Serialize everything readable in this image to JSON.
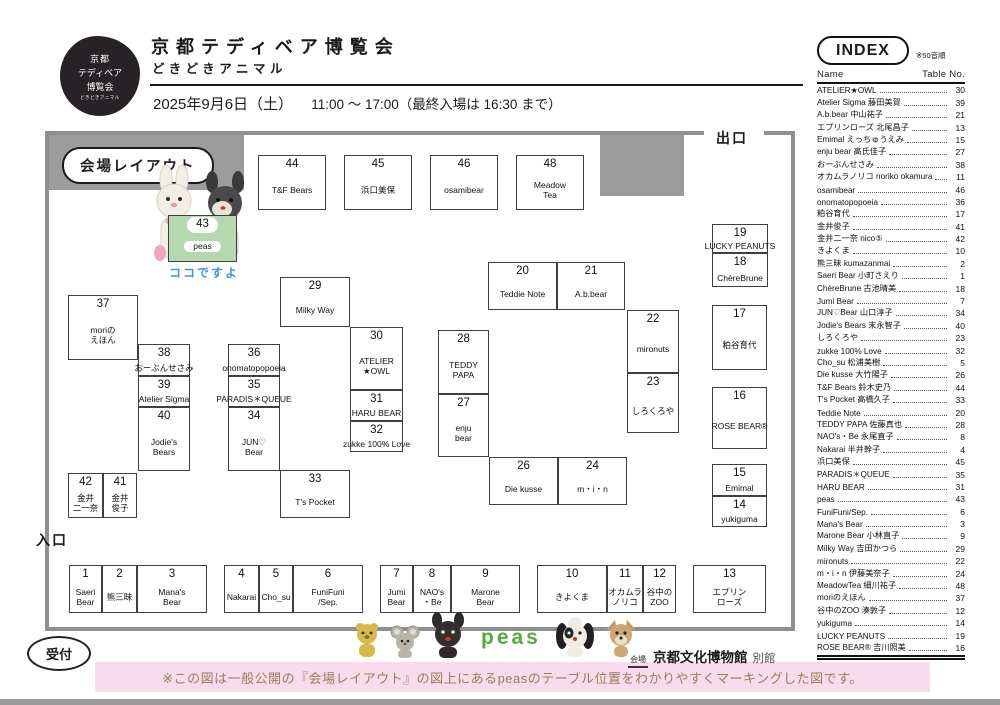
{
  "header": {
    "logo_lines": [
      "京都",
      "テディベア",
      "博覧会",
      "どきどきアニマル"
    ],
    "title": "京都テディベア博覧会",
    "subtitle": "どきどきアニマル",
    "date_main": "2025年9月6日（土）",
    "date_time": "11:00 ～ 17:00（最終入場は 16:30 まで）"
  },
  "index": {
    "title": "INDEX",
    "note": "※50音順",
    "col_name": "Name",
    "col_table": "Table No.",
    "entries": [
      {
        "name": "ATELIER★OWL",
        "no": 30
      },
      {
        "name": "Atelier Sigma 藤田美賀",
        "no": 39
      },
      {
        "name": "A.b.bear 中山祐子",
        "no": 21
      },
      {
        "name": "エプリンローズ 北尾昌子",
        "no": 13
      },
      {
        "name": "Emimal えっちゅうえみ",
        "no": 15
      },
      {
        "name": "enju bear 高氏佳子",
        "no": 27
      },
      {
        "name": "おーぶんせさみ",
        "no": 38
      },
      {
        "name": "オカムラノリコ noriko okamura",
        "no": 11
      },
      {
        "name": "osamibear",
        "no": 46
      },
      {
        "name": "onomatopopoeia",
        "no": 36
      },
      {
        "name": "粕谷育代",
        "no": 17
      },
      {
        "name": "金井俊子",
        "no": 41
      },
      {
        "name": "金井二一奈 nico⑤",
        "no": 42
      },
      {
        "name": "きよくま",
        "no": 10
      },
      {
        "name": "熊三昧 kumazanmai",
        "no": 2
      },
      {
        "name": "Saeri Bear 小町さえり",
        "no": 1
      },
      {
        "name": "ChèreBrune 古池晴美",
        "no": 18
      },
      {
        "name": "Jumi Bear",
        "no": 7
      },
      {
        "name": "JUN♡Bear 山口淳子",
        "no": 34
      },
      {
        "name": "Jodie's Bears 末永智子",
        "no": 40
      },
      {
        "name": "しろくろや",
        "no": 23
      },
      {
        "name": "zukke 100% Love",
        "no": 32
      },
      {
        "name": "Cho_su 松浦美樹",
        "no": 5
      },
      {
        "name": "Die kusse 大竹陽子",
        "no": 26
      },
      {
        "name": "T&F Bears 鈴木史乃",
        "no": 44
      },
      {
        "name": "T's Pocket 高橋久子",
        "no": 33
      },
      {
        "name": "Teddie Note",
        "no": 20
      },
      {
        "name": "TEDDY PAPA 佐藤真也",
        "no": 28
      },
      {
        "name": "NAO's・Be 永尾直子",
        "no": 8
      },
      {
        "name": "Nakarai 半井幹子",
        "no": 4
      },
      {
        "name": "浜口美保",
        "no": 45
      },
      {
        "name": "PARADIS＊QUEUE",
        "no": 35
      },
      {
        "name": "HARU BEAR",
        "no": 31
      },
      {
        "name": "peas",
        "no": 43
      },
      {
        "name": "FuniFuni/Sep.",
        "no": 6
      },
      {
        "name": "Mana's Bear",
        "no": 3
      },
      {
        "name": "Marone Bear 小林直子",
        "no": 9
      },
      {
        "name": "Milky Way 吉田かつら",
        "no": 29
      },
      {
        "name": "mironuts",
        "no": 22
      },
      {
        "name": "m・i・n 伊藤美奈子",
        "no": 24
      },
      {
        "name": "MeadowTea 細川祐子",
        "no": 48
      },
      {
        "name": "moriのえほん",
        "no": 37
      },
      {
        "name": "谷中のZOO 湊敦子",
        "no": 12
      },
      {
        "name": "yukiguma",
        "no": 14
      },
      {
        "name": "LUCKY PEANUTS",
        "no": 19
      },
      {
        "name": "ROSE BEAR® 吉川照美",
        "no": 16
      }
    ]
  },
  "map": {
    "legend_label": "会場レイアウト",
    "exit_label": "出口",
    "entrance_label": "入口",
    "reception_label": "受付",
    "here_label": "ココですよ",
    "highlight_table": "43",
    "highlight_name": "peas",
    "tables": [
      {
        "no": "44",
        "label": "T&F Bears",
        "x": 258,
        "y": 155,
        "w": 68,
        "h": 55
      },
      {
        "no": "45",
        "label": "浜口美保",
        "x": 344,
        "y": 155,
        "w": 68,
        "h": 55
      },
      {
        "no": "46",
        "label": "osamibear",
        "x": 430,
        "y": 155,
        "w": 68,
        "h": 55
      },
      {
        "no": "48",
        "label": "Meadow\nTea",
        "x": 516,
        "y": 155,
        "w": 68,
        "h": 55
      },
      {
        "no": "43",
        "label": "peas",
        "x": 168,
        "y": 215,
        "w": 69,
        "h": 47,
        "hl": true
      },
      {
        "no": "37",
        "label": "moriの\nえほん",
        "x": 68,
        "y": 295,
        "w": 70,
        "h": 65
      },
      {
        "no": "38",
        "label": "おーぶんせさみ",
        "x": 138,
        "y": 344,
        "w": 52,
        "h": 32
      },
      {
        "no": "39",
        "label": "Atelier Sigma",
        "x": 138,
        "y": 376,
        "w": 52,
        "h": 31
      },
      {
        "no": "40",
        "label": "Jodie's\nBears",
        "x": 138,
        "y": 407,
        "w": 52,
        "h": 64
      },
      {
        "no": "42",
        "label": "金井\n二一奈",
        "x": 68,
        "y": 473,
        "w": 35,
        "h": 45
      },
      {
        "no": "41",
        "label": "金井\n俊子",
        "x": 103,
        "y": 473,
        "w": 34,
        "h": 45
      },
      {
        "no": "36",
        "label": "onomatopopoeia",
        "x": 228,
        "y": 344,
        "w": 52,
        "h": 32
      },
      {
        "no": "35",
        "label": "PARADIS＊QUEUE",
        "x": 228,
        "y": 376,
        "w": 52,
        "h": 31
      },
      {
        "no": "34",
        "label": "JUN♡\nBear",
        "x": 228,
        "y": 407,
        "w": 52,
        "h": 64
      },
      {
        "no": "33",
        "label": "T's Pocket",
        "x": 280,
        "y": 470,
        "w": 70,
        "h": 48
      },
      {
        "no": "29",
        "label": "Milky Way",
        "x": 280,
        "y": 277,
        "w": 70,
        "h": 50
      },
      {
        "no": "30",
        "label": "ATELIER\n★OWL",
        "x": 350,
        "y": 327,
        "w": 53,
        "h": 63
      },
      {
        "no": "31",
        "label": "HARU BEAR",
        "x": 350,
        "y": 390,
        "w": 53,
        "h": 31
      },
      {
        "no": "32",
        "label": "zukke 100% Love",
        "x": 350,
        "y": 421,
        "w": 53,
        "h": 31
      },
      {
        "no": "20",
        "label": "Teddie Note",
        "x": 488,
        "y": 262,
        "w": 69,
        "h": 48
      },
      {
        "no": "21",
        "label": "A.b.bear",
        "x": 557,
        "y": 262,
        "w": 68,
        "h": 48
      },
      {
        "no": "22",
        "label": "mironuts",
        "x": 627,
        "y": 310,
        "w": 52,
        "h": 63
      },
      {
        "no": "23",
        "label": "しろくろや",
        "x": 627,
        "y": 373,
        "w": 52,
        "h": 60
      },
      {
        "no": "28",
        "label": "TEDDY\nPAPA",
        "x": 438,
        "y": 330,
        "w": 51,
        "h": 64
      },
      {
        "no": "27",
        "label": "enju\nbear",
        "x": 438,
        "y": 394,
        "w": 51,
        "h": 63
      },
      {
        "no": "26",
        "label": "Die kusse",
        "x": 489,
        "y": 457,
        "w": 69,
        "h": 48
      },
      {
        "no": "24",
        "label": "m・i・n",
        "x": 558,
        "y": 457,
        "w": 69,
        "h": 48
      },
      {
        "no": "19",
        "label": "LUCKY PEANUTS",
        "x": 712,
        "y": 224,
        "w": 56,
        "h": 29
      },
      {
        "no": "18",
        "label": "ChèreBrune",
        "x": 712,
        "y": 253,
        "w": 56,
        "h": 34
      },
      {
        "no": "17",
        "label": "粕谷育代",
        "x": 712,
        "y": 305,
        "w": 55,
        "h": 65
      },
      {
        "no": "16",
        "label": "ROSE BEAR®",
        "x": 712,
        "y": 387,
        "w": 55,
        "h": 62
      },
      {
        "no": "15",
        "label": "Emimal",
        "x": 712,
        "y": 464,
        "w": 55,
        "h": 32
      },
      {
        "no": "14",
        "label": "yukiguma",
        "x": 712,
        "y": 496,
        "w": 55,
        "h": 31
      },
      {
        "no": "1",
        "label": "Saeri\nBear",
        "x": 69,
        "y": 565,
        "w": 33,
        "h": 48
      },
      {
        "no": "2",
        "label": "熊三昧",
        "x": 102,
        "y": 565,
        "w": 35,
        "h": 48
      },
      {
        "no": "3",
        "label": "Mana's\nBear",
        "x": 137,
        "y": 565,
        "w": 70,
        "h": 48
      },
      {
        "no": "4",
        "label": "Nakarai",
        "x": 224,
        "y": 565,
        "w": 35,
        "h": 48
      },
      {
        "no": "5",
        "label": "Cho_su",
        "x": 259,
        "y": 565,
        "w": 34,
        "h": 48
      },
      {
        "no": "6",
        "label": "FuniFuni\n/Sep.",
        "x": 293,
        "y": 565,
        "w": 70,
        "h": 48
      },
      {
        "no": "7",
        "label": "Jumi\nBear",
        "x": 380,
        "y": 565,
        "w": 33,
        "h": 48
      },
      {
        "no": "8",
        "label": "NAO's\n・Be",
        "x": 413,
        "y": 565,
        "w": 38,
        "h": 48
      },
      {
        "no": "9",
        "label": "Marone\nBear",
        "x": 451,
        "y": 565,
        "w": 69,
        "h": 48
      },
      {
        "no": "10",
        "label": "きよくま",
        "x": 537,
        "y": 565,
        "w": 70,
        "h": 48
      },
      {
        "no": "11",
        "label": "オカムラ\nノリコ",
        "x": 607,
        "y": 565,
        "w": 36,
        "h": 48
      },
      {
        "no": "12",
        "label": "谷中の\nZOO",
        "x": 643,
        "y": 565,
        "w": 33,
        "h": 48
      },
      {
        "no": "13",
        "label": "エプリン\nローズ",
        "x": 693,
        "y": 565,
        "w": 73,
        "h": 48
      }
    ]
  },
  "footer": {
    "brand": "peas",
    "venue_tag": "会場",
    "venue_name": "京都文化博物館",
    "venue_suffix": "別館",
    "note": "※この図は一般公開の『会場レイアウト』の図上にあるpeasのテーブル位置をわかりやすくマーキングした図です。"
  },
  "colors": {
    "highlight_green": "#b5d9ae",
    "note_pink": "#f8dcec",
    "note_brown": "#9c7b5e",
    "here_blue": "#3f96e0",
    "wall_gray": "#8f8f8f"
  }
}
